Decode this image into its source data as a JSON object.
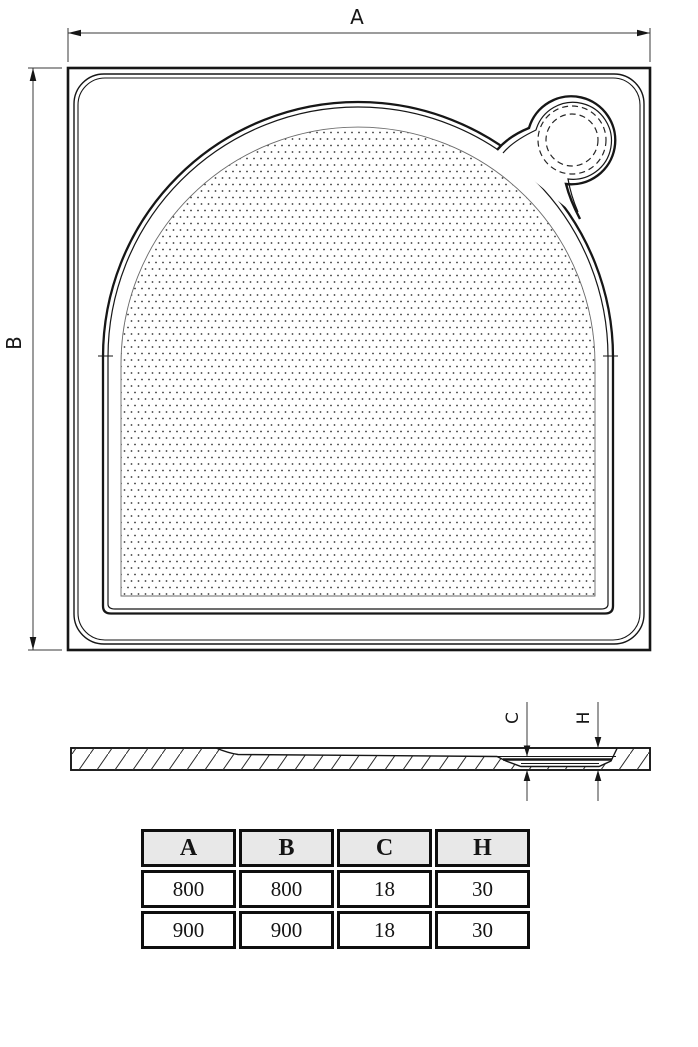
{
  "drawing": {
    "labels": {
      "a": "A",
      "b": "B",
      "c": "C",
      "h": "H"
    }
  },
  "table": {
    "columns": [
      "A",
      "B",
      "C",
      "H"
    ],
    "rows": [
      [
        "800",
        "800",
        "18",
        "30"
      ],
      [
        "900",
        "900",
        "18",
        "30"
      ]
    ]
  },
  "colors": {
    "line": "#161616",
    "dim_line": "#3a3a3a",
    "table_header_bg": "#e8e8e8"
  }
}
